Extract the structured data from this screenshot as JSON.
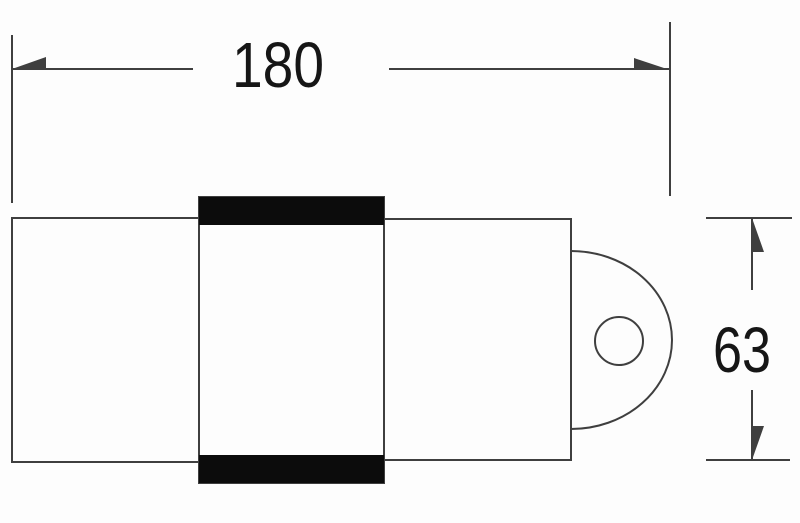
{
  "drawing": {
    "kind": "technical-dimension-drawing",
    "colors": {
      "stroke": "#3f3f3f",
      "band_fill": "#0c0c0c",
      "text": "#161616",
      "background": "#fdfdfd"
    },
    "dim_width": {
      "label": "180"
    },
    "dim_height": {
      "label": "63"
    }
  }
}
